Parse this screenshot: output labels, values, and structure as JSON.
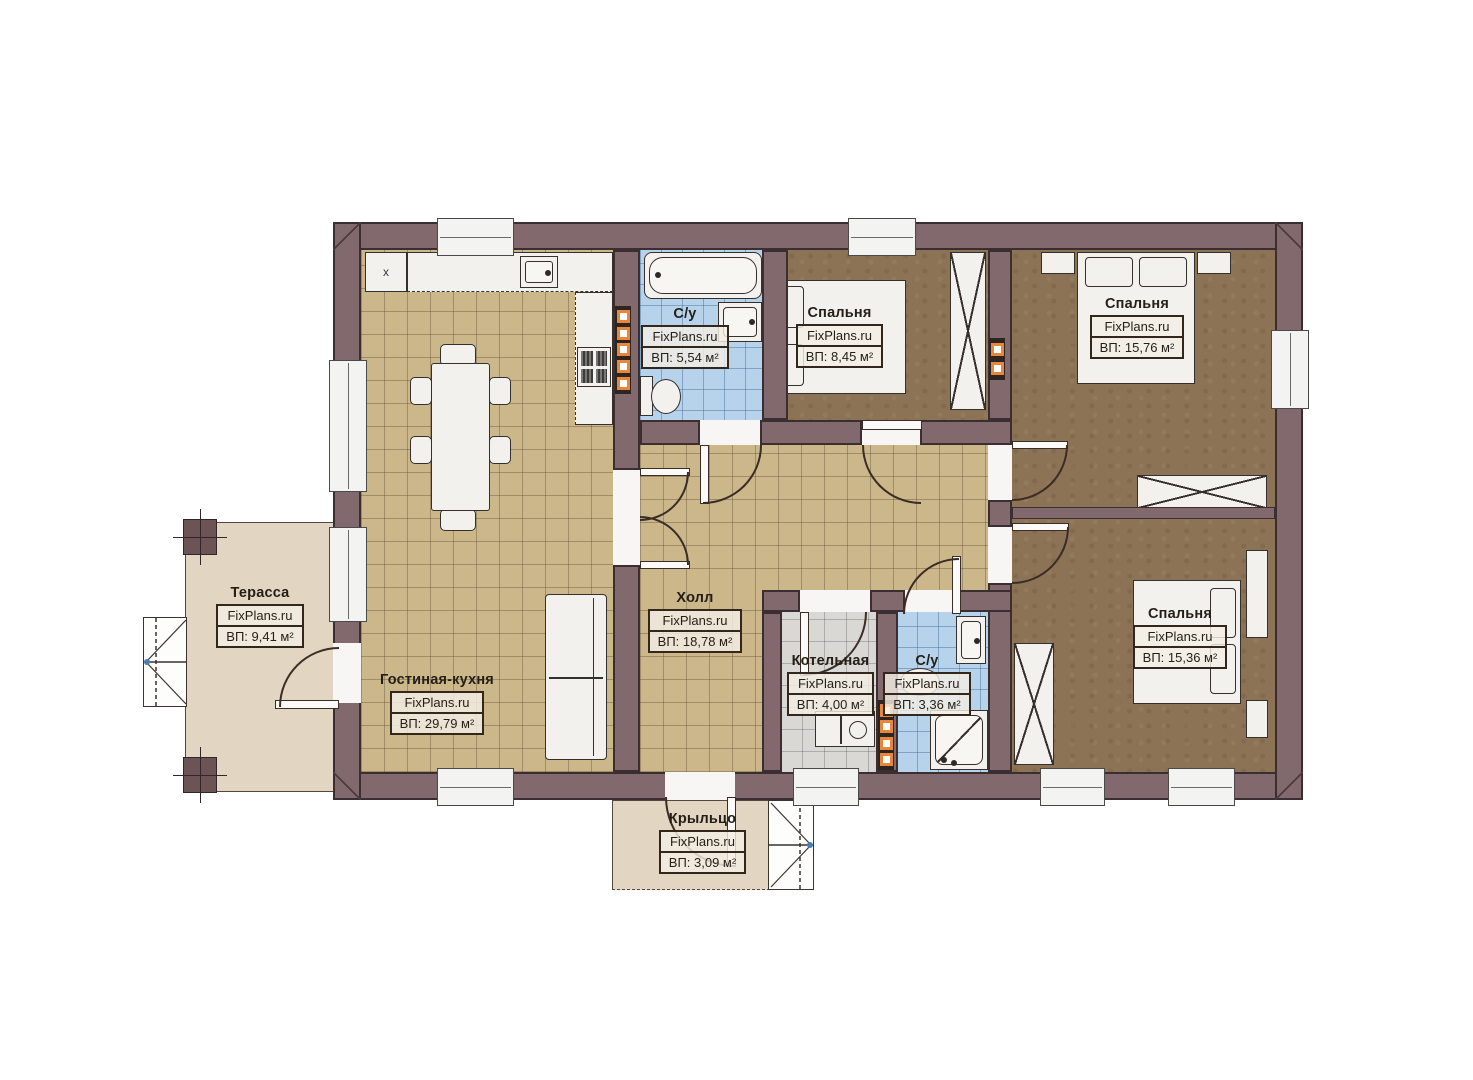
{
  "plan": {
    "watermark": "FixPlans.ru",
    "kitchen": {
      "fridge_marker": "x"
    },
    "rooms": [
      {
        "key": "terrace",
        "name": "Терасса",
        "watermark": "FixPlans.ru",
        "area": "ВП: 9,41 м²"
      },
      {
        "key": "living-kitchen",
        "name": "Гостиная-кухня",
        "watermark": "FixPlans.ru",
        "area": "ВП: 29,79 м²"
      },
      {
        "key": "bathroom-1",
        "name": "С/у",
        "watermark": "FixPlans.ru",
        "area": "ВП: 5,54 м²"
      },
      {
        "key": "bedroom-1",
        "name": "Спальня",
        "watermark": "FixPlans.ru",
        "area": "ВП: 8,45 м²"
      },
      {
        "key": "bedroom-2",
        "name": "Спальня",
        "watermark": "FixPlans.ru",
        "area": "ВП: 15,76 м²"
      },
      {
        "key": "hall",
        "name": "Холл",
        "watermark": "FixPlans.ru",
        "area": "ВП: 18,78 м²"
      },
      {
        "key": "boiler-room",
        "name": "Котельная",
        "watermark": "FixPlans.ru",
        "area": "ВП: 4,00 м²"
      },
      {
        "key": "bathroom-2",
        "name": "С/у",
        "watermark": "FixPlans.ru",
        "area": "ВП: 3,36 м²"
      },
      {
        "key": "bedroom-3",
        "name": "Спальня",
        "watermark": "FixPlans.ru",
        "area": "ВП: 15,36 м²"
      },
      {
        "key": "porch",
        "name": "Крыльцо",
        "watermark": "FixPlans.ru",
        "area": "ВП: 3,09 м²"
      }
    ],
    "colors": {
      "wall": "#82696d",
      "floor_tile": "#ccb78b",
      "carpet": "#8c7355",
      "bath_tile": "#b7d3ec",
      "boiler_tile": "#d9d8d5",
      "deck": "#e2d5c1",
      "vent_accent": "#e8873c"
    }
  }
}
